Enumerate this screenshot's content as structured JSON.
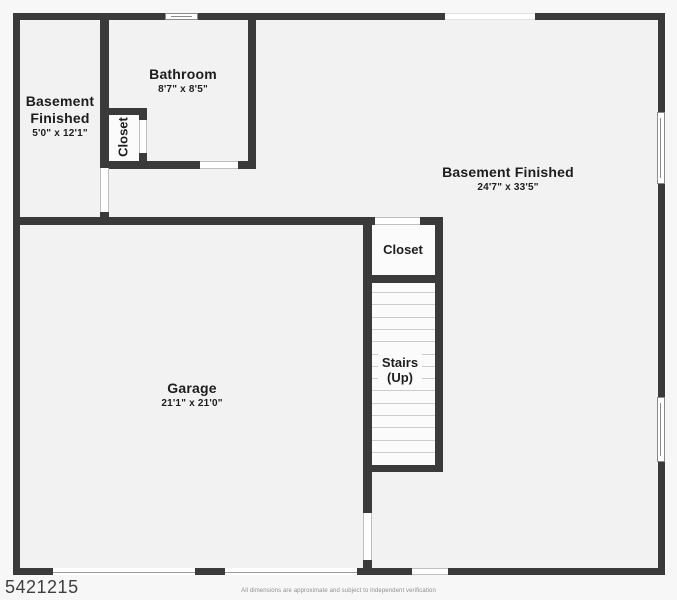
{
  "page": {
    "listing_id": "5421215",
    "disclaimer": "All dimensions are approximate and subject to independent verification"
  },
  "colors": {
    "wall": "#3a3a3a",
    "floor": "#f2f2f2",
    "closet_floor": "#fbfbfb",
    "page_bg": "#f7f7f7",
    "jamb": "#c0c0c0",
    "window_frame": "#8a8a8a",
    "tread": "#cccccc",
    "label": "#1d1d1d"
  },
  "rooms": {
    "bathroom": {
      "name": "Bathroom",
      "dims": "8'7\" x 8'5\""
    },
    "basement_left": {
      "name_line1": "Basement",
      "name_line2": "Finished",
      "dims": "5'0\" x 12'1\""
    },
    "basement_main": {
      "name": "Basement Finished",
      "dims": "24'7\" x 33'5\""
    },
    "garage": {
      "name": "Garage",
      "dims": "21'1\" x 21'0\""
    },
    "bathroom_closet": {
      "name": "Closet"
    },
    "hall_closet": {
      "name": "Closet"
    },
    "stairs": {
      "name_line1": "Stairs",
      "name_line2": "(Up)"
    }
  },
  "floorplan": {
    "floor_areas": [
      [
        13,
        13,
        652,
        562
      ]
    ],
    "light_areas": [
      [
        109,
        115,
        30,
        46
      ],
      [
        372,
        225,
        63,
        50
      ],
      [
        372,
        283,
        63,
        182
      ]
    ],
    "walls": [
      [
        13,
        13,
        152,
        7
      ],
      [
        198,
        13,
        247,
        7
      ],
      [
        535,
        13,
        130,
        7
      ],
      [
        13,
        13,
        7,
        562
      ],
      [
        658,
        13,
        7,
        99
      ],
      [
        658,
        184,
        7,
        213
      ],
      [
        658,
        462,
        7,
        113
      ],
      [
        13,
        568,
        40,
        7
      ],
      [
        195,
        568,
        30,
        7
      ],
      [
        357,
        568,
        55,
        7
      ],
      [
        448,
        568,
        217,
        7
      ],
      [
        100,
        20,
        9,
        148
      ],
      [
        100,
        212,
        9,
        5
      ],
      [
        100,
        108,
        47,
        7
      ],
      [
        139,
        108,
        8,
        12
      ],
      [
        139,
        153,
        8,
        16
      ],
      [
        100,
        161,
        100,
        8
      ],
      [
        238,
        161,
        18,
        8
      ],
      [
        248,
        20,
        8,
        149
      ],
      [
        13,
        217,
        362,
        8
      ],
      [
        420,
        217,
        23,
        8
      ],
      [
        363,
        225,
        9,
        288
      ],
      [
        363,
        560,
        9,
        8
      ],
      [
        435,
        225,
        8,
        247
      ],
      [
        363,
        275,
        80,
        8
      ],
      [
        363,
        465,
        80,
        7
      ]
    ],
    "door_openings": [
      [
        139,
        120,
        8,
        33
      ],
      [
        100,
        168,
        9,
        44
      ],
      [
        200,
        161,
        38,
        8
      ],
      [
        375,
        217,
        45,
        8
      ],
      [
        363,
        513,
        9,
        47
      ],
      [
        412,
        568,
        36,
        7
      ]
    ],
    "wall_openings": [
      [
        445,
        13,
        90,
        7
      ]
    ],
    "garage_doors": [
      [
        53,
        568,
        142,
        7
      ],
      [
        225,
        568,
        132,
        7
      ]
    ],
    "windows": [
      [
        165,
        13,
        33,
        7
      ],
      [
        657,
        112,
        8,
        72
      ],
      [
        657,
        397,
        8,
        65
      ]
    ],
    "stair_treads": {
      "x": 372,
      "width": 63,
      "y_start": 292,
      "y_end": 452,
      "count": 14
    }
  }
}
